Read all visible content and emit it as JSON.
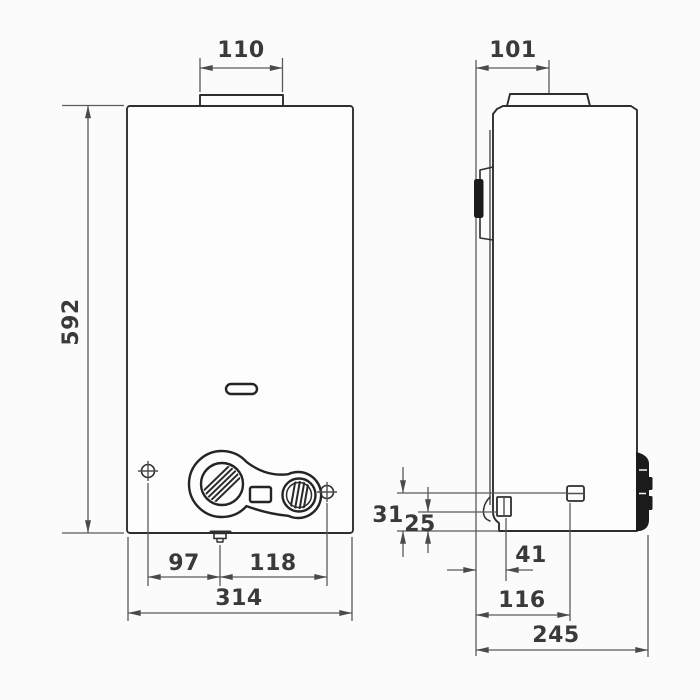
{
  "drawing": {
    "type": "technical-dimension-drawing",
    "views": {
      "front": "front-view",
      "side": "side-view"
    }
  },
  "dimensions": {
    "front": {
      "flue_width": "110",
      "height": "592",
      "left_offset": "97",
      "right_offset": "118",
      "width": "314"
    },
    "side": {
      "flue_offset": "101",
      "upper_offset": "31",
      "lower_offset": "25",
      "gas_offset": "41",
      "water_offset": "116",
      "depth": "245"
    }
  },
  "colors": {
    "background": "#fbfbfb",
    "outline": "#2e2e2e",
    "dimension_line": "#5a5a5a",
    "text": "#3a3a3a",
    "dark_fill": "#1b1b1b"
  }
}
